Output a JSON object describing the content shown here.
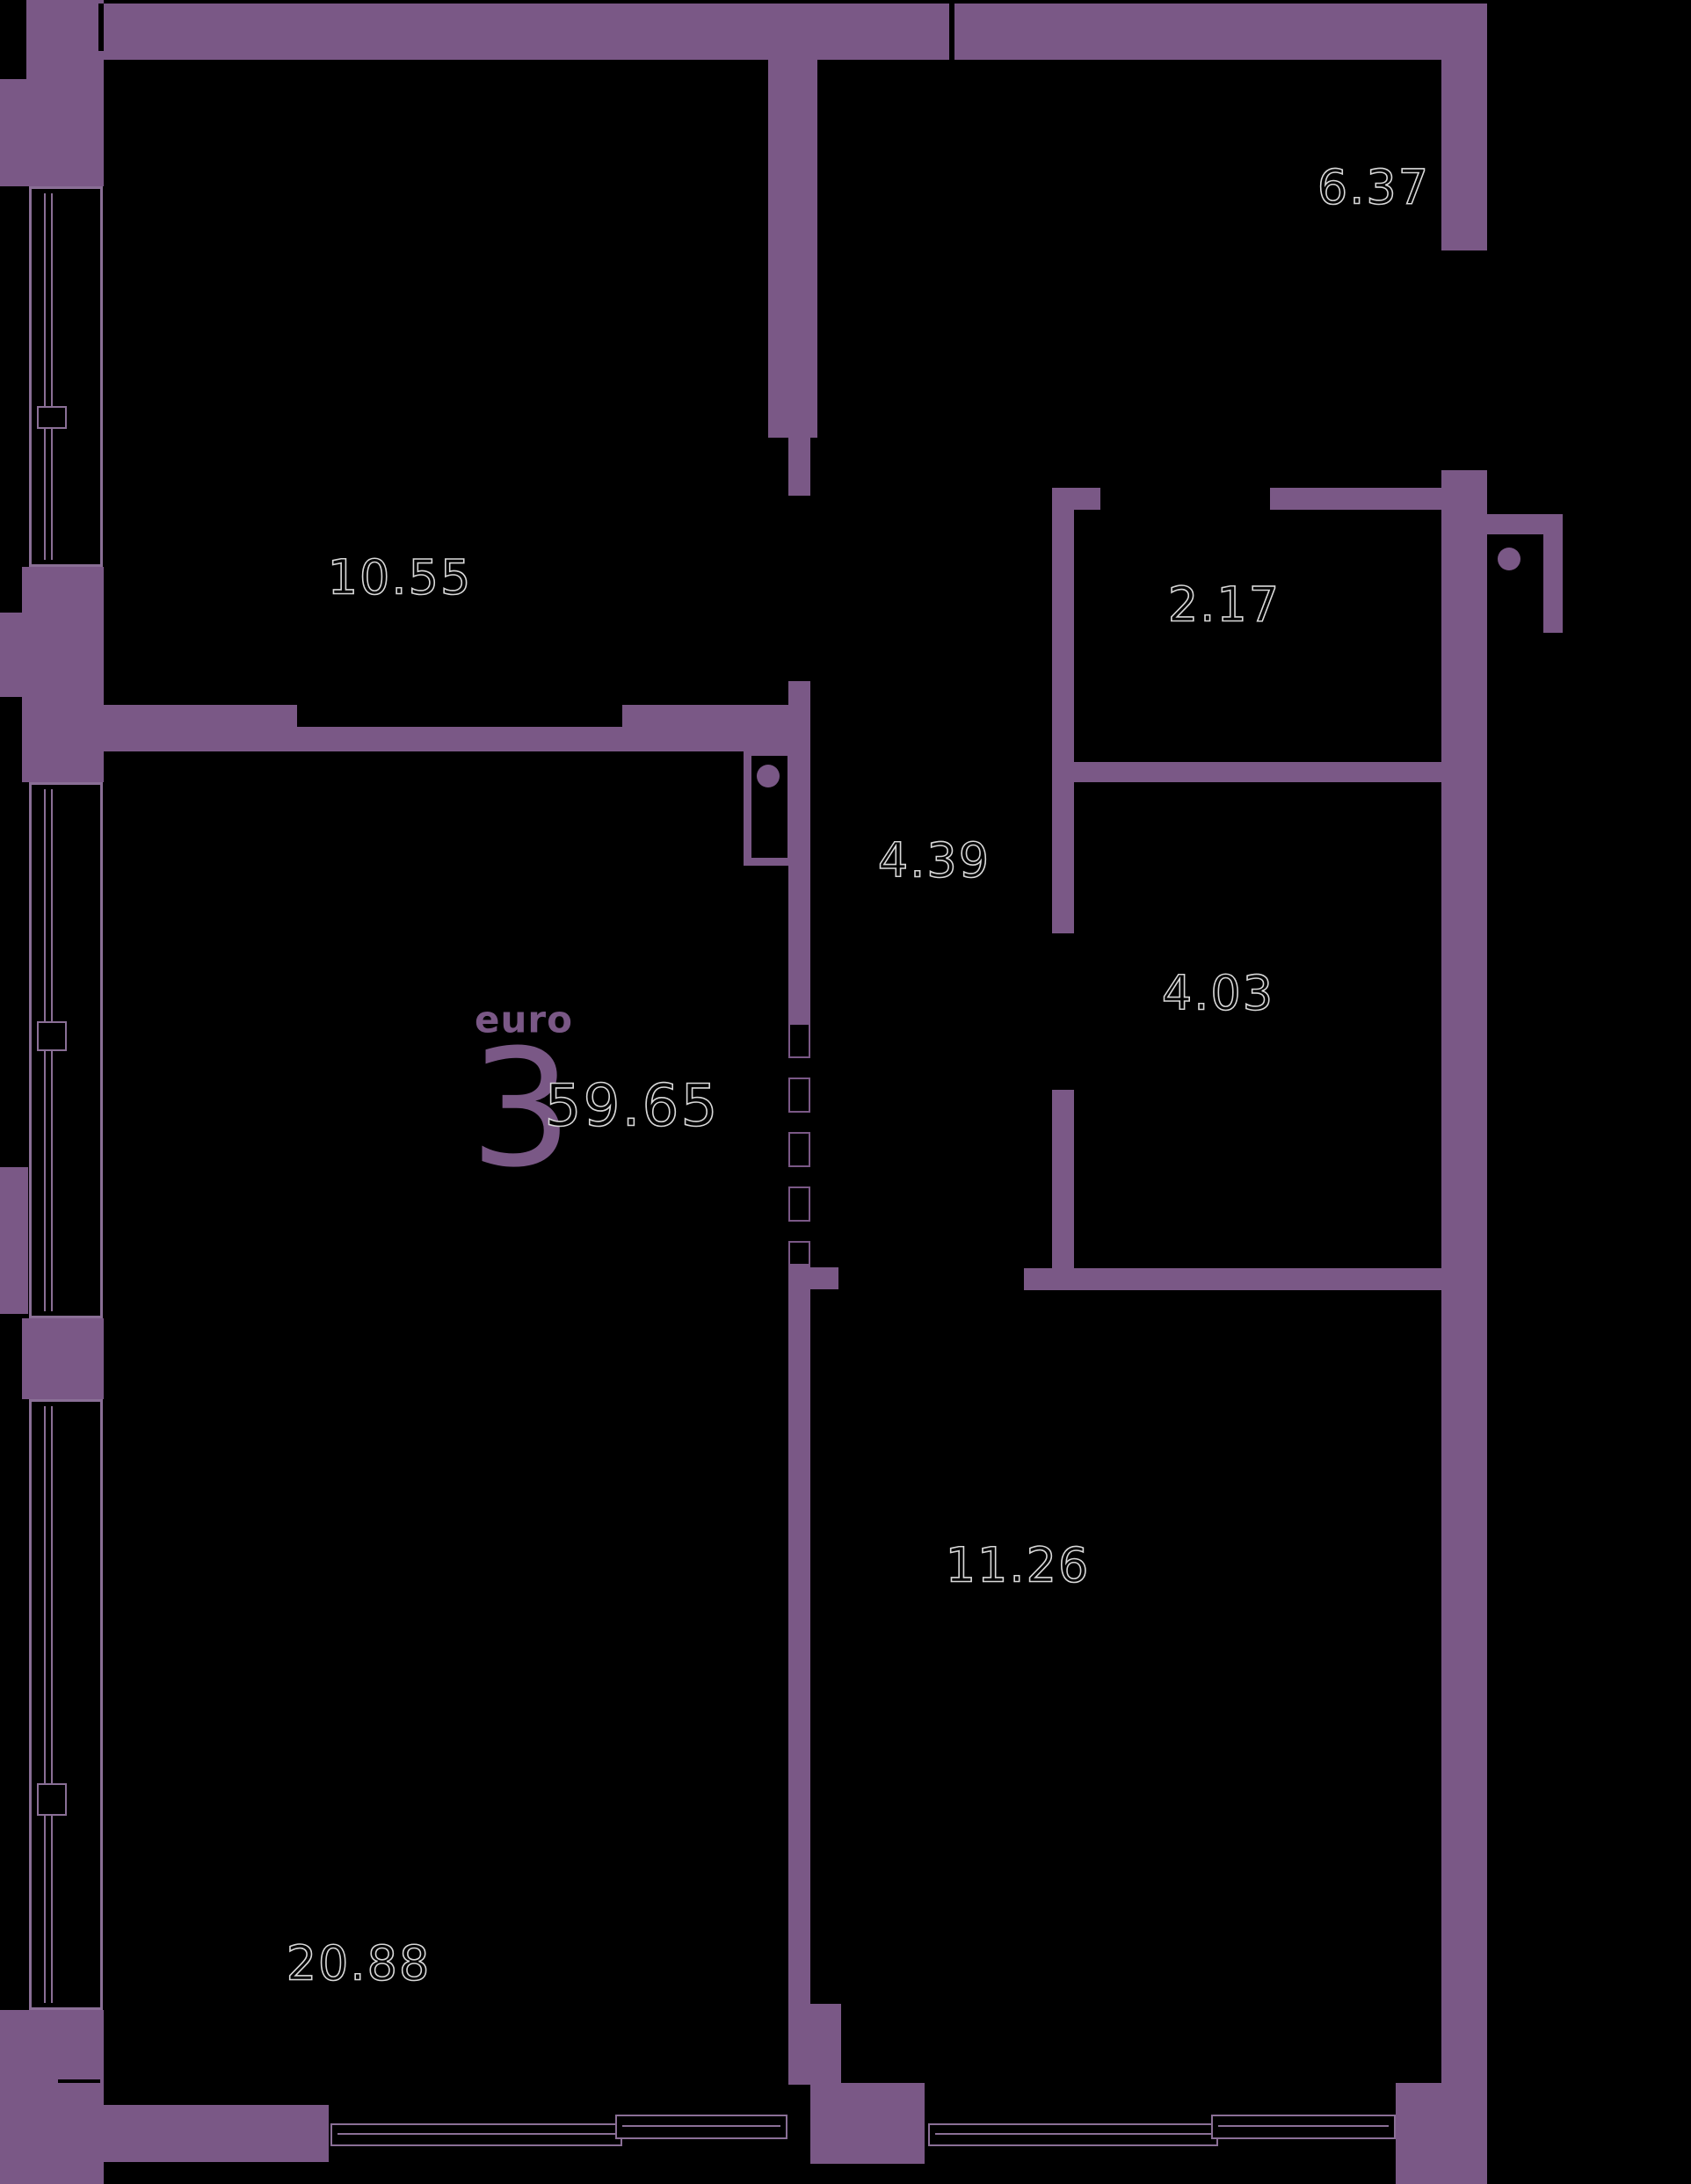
{
  "plan": {
    "background": "#000000",
    "wall_color": "#7a5886",
    "label_outline_color": "#d9d9d9",
    "window_line_color": "#8a6f96",
    "apartment": {
      "type_label": "euro",
      "rooms_count": "3",
      "total_area": "59.65"
    },
    "rooms": [
      {
        "name": "room-top-left",
        "area": "10.55"
      },
      {
        "name": "room-top-right",
        "area": "6.37"
      },
      {
        "name": "room-wc",
        "area": "2.17"
      },
      {
        "name": "hallway",
        "area": "4.39"
      },
      {
        "name": "bathroom",
        "area": "4.03"
      },
      {
        "name": "room-bottom-right",
        "area": "11.26"
      },
      {
        "name": "living-room",
        "area": "20.88"
      }
    ]
  }
}
